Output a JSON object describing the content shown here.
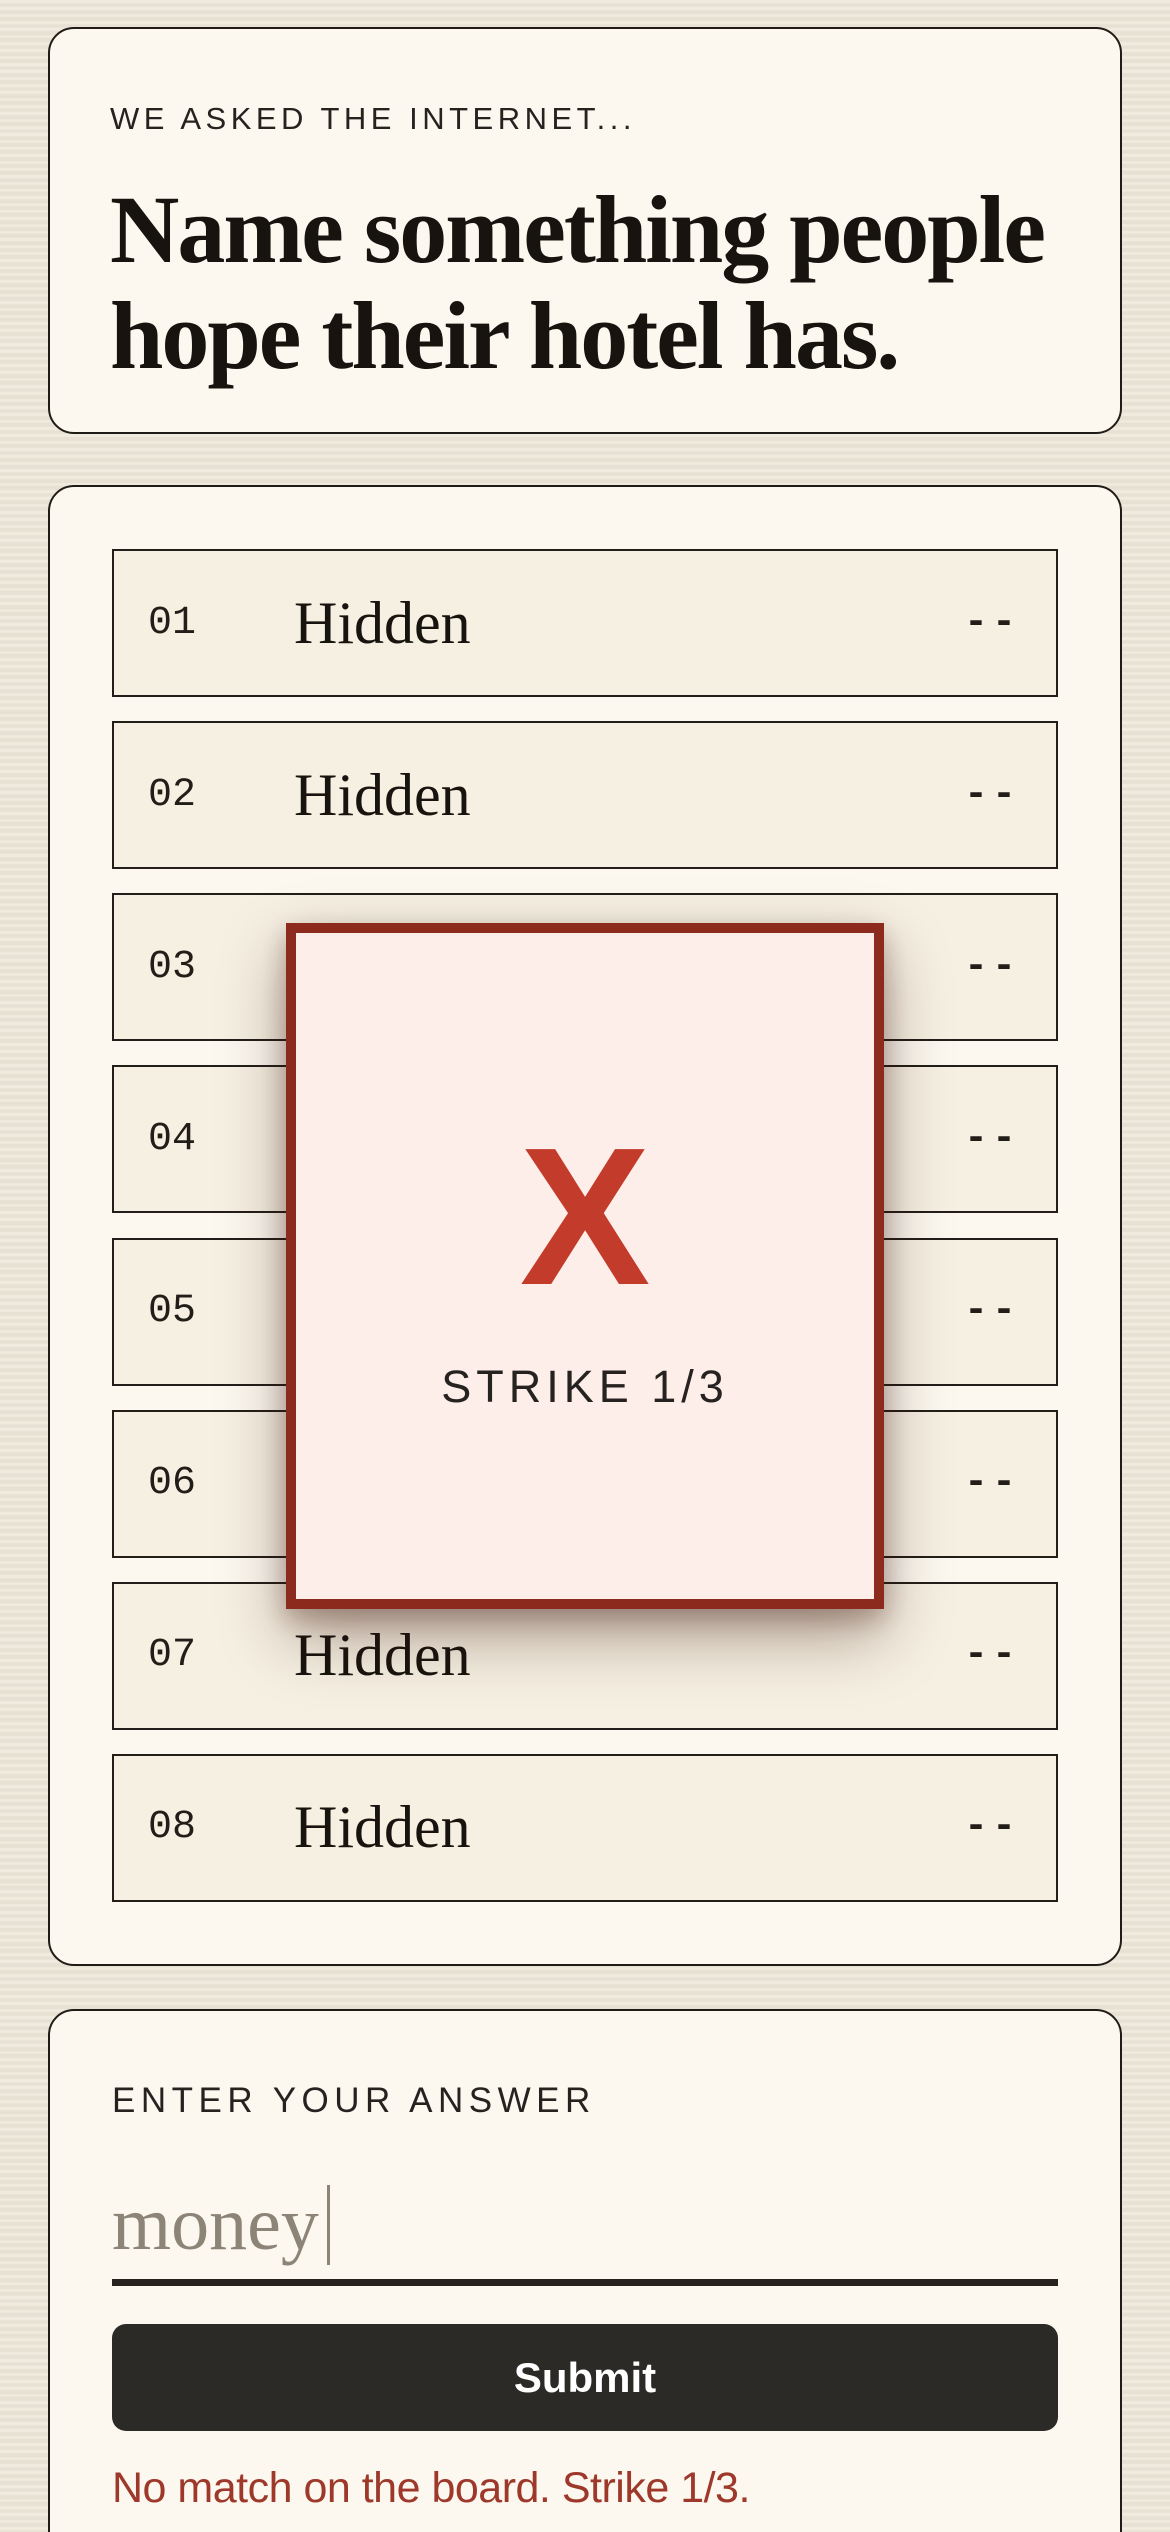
{
  "question": {
    "kicker": "WE ASKED THE INTERNET...",
    "headline_lines": [
      "Name something people",
      "hope their hotel has."
    ]
  },
  "board": {
    "hidden_label": "Hidden",
    "rows": [
      {
        "number": "01",
        "answer": "Hidden",
        "points": "--"
      },
      {
        "number": "02",
        "answer": "Hidden",
        "points": "--"
      },
      {
        "number": "03",
        "answer": "Hidden",
        "points": "--"
      },
      {
        "number": "04",
        "answer": "Hidden",
        "points": "--"
      },
      {
        "number": "05",
        "answer": "Hidden",
        "points": "--"
      },
      {
        "number": "06",
        "answer": "Hidden",
        "points": "--"
      },
      {
        "number": "07",
        "answer": "Hidden",
        "points": "--"
      },
      {
        "number": "08",
        "answer": "Hidden",
        "points": "--"
      }
    ]
  },
  "strike_modal": {
    "x_mark": "X",
    "label": "STRIKE 1/3",
    "strikes_used": 1,
    "strikes_max": 3
  },
  "answer_form": {
    "label": "ENTER YOUR ANSWER",
    "input_value": "money",
    "submit_label": "Submit",
    "error_message": "No match on the board. Strike 1/3."
  },
  "colors": {
    "page_background": "#eae4d7",
    "card_background": "#fcf8ef",
    "row_background": "#f6f0e2",
    "ink": "#17130e",
    "accent_red": "#c33b2a",
    "modal_border": "#8c2a1d",
    "modal_background": "#fdeeea",
    "error_red": "#9d382a",
    "submit_background": "#2b2a27",
    "muted_input_text": "#8d8478"
  }
}
